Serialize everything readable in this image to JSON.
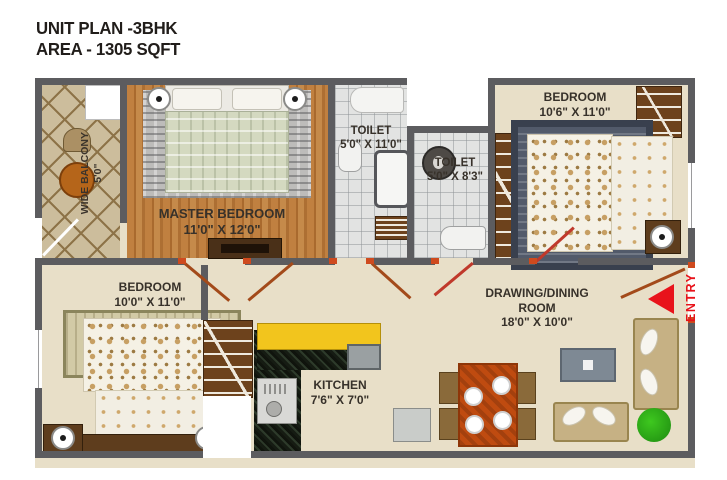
{
  "title": {
    "line1": "UNIT PLAN -3BHK",
    "line2": "AREA - 1305 SQFT"
  },
  "entry": {
    "label": "ENTRY",
    "arrow_color": "#e8131b"
  },
  "rooms": {
    "master_bedroom": {
      "name": "MASTER BEDROOM",
      "dims": "11'0\" X 12'0\""
    },
    "toilet_1": {
      "name": "TOILET",
      "dims": "5'0\" X 11'0\""
    },
    "toilet_2": {
      "name": "TOILET",
      "dims": "5'0\" X 8'3\""
    },
    "bedroom_top_right": {
      "name": "BEDROOM",
      "dims": "10'6\" X 11'0\""
    },
    "bedroom_bottom_left": {
      "name": "BEDROOM",
      "dims": "10'0\" X 11'0\""
    },
    "kitchen": {
      "name": "KITCHEN",
      "dims": "7'6\" X 7'0\""
    },
    "drawing_dining": {
      "name_line1": "DRAWING/DINING",
      "name_line2": "ROOM",
      "dims": "18'0\" X 10'0\""
    },
    "balcony": {
      "name": "WIDE BALCONY",
      "dims": "5'0\""
    }
  },
  "colors": {
    "wall": "#5c5c5f",
    "entry_red": "#e8131b",
    "kitchen_counter_yellow": "#f2c51d",
    "floor_beige": "#e8dfc8",
    "wood_floor": "#b8783c"
  }
}
